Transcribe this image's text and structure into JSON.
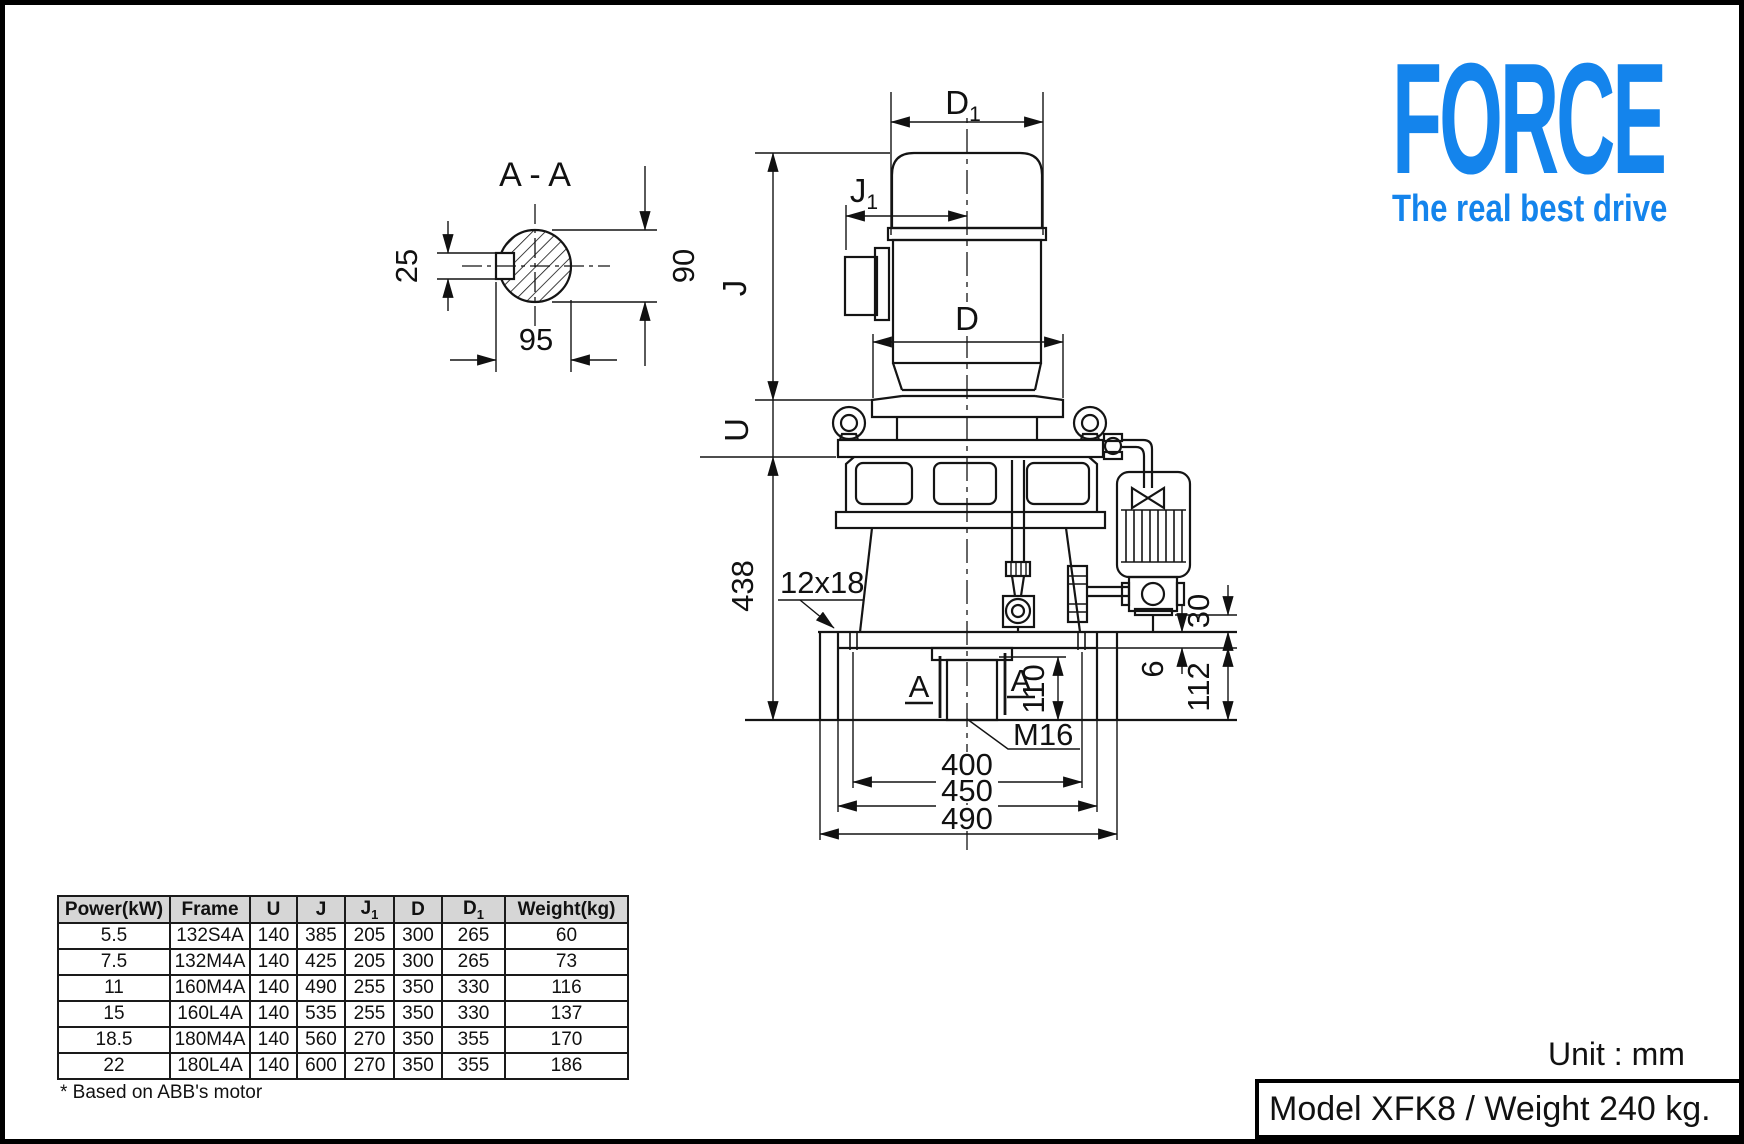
{
  "brand": {
    "name": "FORCE",
    "tagline": "The real best drive",
    "color": "#1484ec"
  },
  "section": {
    "title": "A - A",
    "dim_25": "25",
    "dim_90": "90",
    "dim_95": "95"
  },
  "drawing": {
    "dim_d1": "D",
    "dim_d1_sub": "1",
    "dim_j1": "J",
    "dim_j1_sub": "1",
    "dim_j": "J",
    "dim_d": "D",
    "dim_u": "U",
    "dim_total_height": "438",
    "dim_slot": "12x18",
    "dim_shaft_len": "110",
    "dim_tap": "M16",
    "dim_span_inner": "400",
    "dim_span_mid": "450",
    "dim_span_outer": "490",
    "dim_flange_30": "30",
    "dim_plate_6": "6",
    "dim_base_112": "112",
    "cut_label_left": "A",
    "cut_label_right": "A"
  },
  "table": {
    "headers": [
      "Power(kW)",
      "Frame",
      "U",
      "J",
      "J",
      "D",
      "D",
      "Weight(kg)"
    ],
    "header_subs": [
      "",
      "",
      "",
      "",
      "1",
      "",
      "1",
      ""
    ],
    "rows": [
      [
        "5.5",
        "132S4A",
        "140",
        "385",
        "205",
        "300",
        "265",
        "60"
      ],
      [
        "7.5",
        "132M4A",
        "140",
        "425",
        "205",
        "300",
        "265",
        "73"
      ],
      [
        "11",
        "160M4A",
        "140",
        "490",
        "255",
        "350",
        "330",
        "116"
      ],
      [
        "15",
        "160L4A",
        "140",
        "535",
        "255",
        "350",
        "330",
        "137"
      ],
      [
        "18.5",
        "180M4A",
        "140",
        "560",
        "270",
        "350",
        "355",
        "170"
      ],
      [
        "22",
        "180L4A",
        "140",
        "600",
        "270",
        "350",
        "355",
        "186"
      ]
    ],
    "footnote": "* Based on ABB's motor"
  },
  "page": {
    "unit_label": "Unit : mm",
    "model_label": "Model XFK8 / Weight 240 kg."
  }
}
